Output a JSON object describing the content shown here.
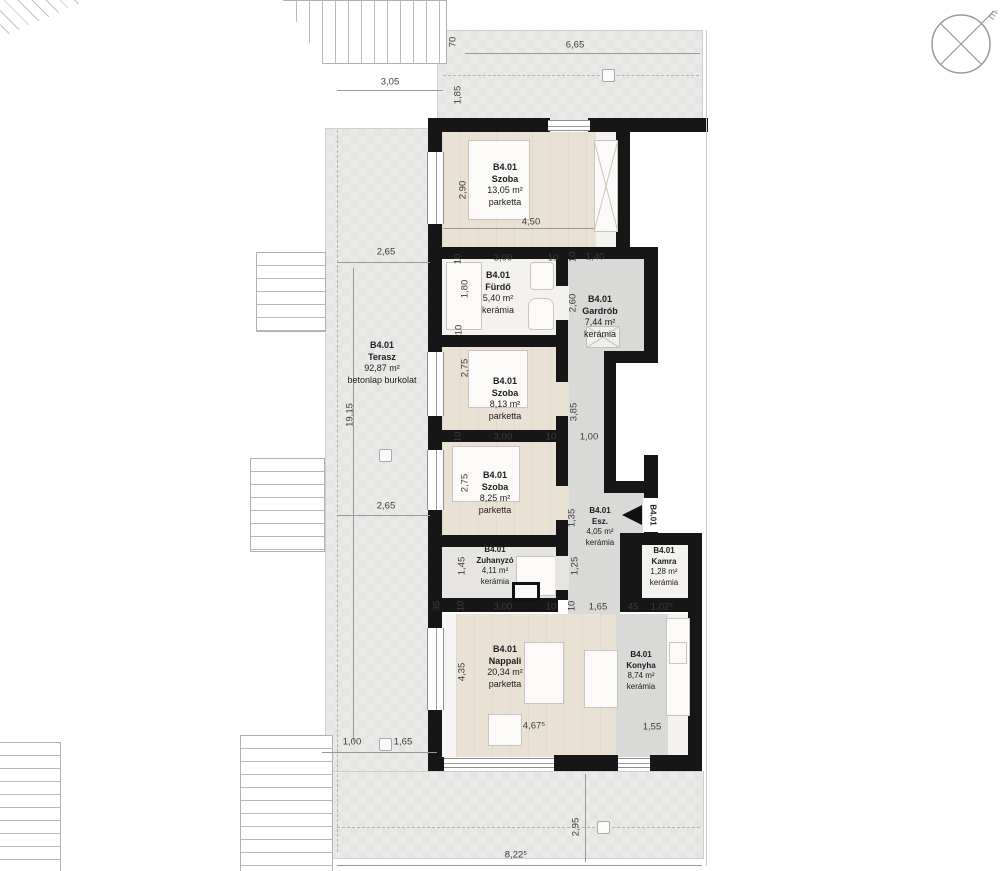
{
  "unit": "B4.01",
  "compass": {
    "north_label": "É"
  },
  "entry": {
    "unit": "B4.01"
  },
  "rooms": [
    {
      "id": "szoba-1",
      "unit": "B4.01",
      "name": "Szoba",
      "area": "13,05 m²",
      "floor": "parketta"
    },
    {
      "id": "furdo",
      "unit": "B4.01",
      "name": "Fürdő",
      "area": "5,40 m²",
      "floor": "kerámia"
    },
    {
      "id": "gardrob",
      "unit": "B4.01",
      "name": "Gardrób",
      "area": "7,44 m²",
      "floor": "kerámia"
    },
    {
      "id": "terasz",
      "unit": "B4.01",
      "name": "Terasz",
      "area": "92,87 m²",
      "floor": "betonlap burkolat"
    },
    {
      "id": "szoba-2",
      "unit": "B4.01",
      "name": "Szoba",
      "area": "8,13 m²",
      "floor": "parketta"
    },
    {
      "id": "szoba-3",
      "unit": "B4.01",
      "name": "Szoba",
      "area": "8,25 m²",
      "floor": "parketta"
    },
    {
      "id": "esz",
      "unit": "B4.01",
      "name": "Esz.",
      "area": "4,05 m²",
      "floor": "kerámia"
    },
    {
      "id": "zuhanyzo",
      "unit": "B4.01",
      "name": "Zuhanyzó",
      "area": "4,11 m²",
      "floor": "kerámia"
    },
    {
      "id": "kamra",
      "unit": "B4.01",
      "name": "Kamra",
      "area": "1,28 m²",
      "floor": "kerámia"
    },
    {
      "id": "nappali",
      "unit": "B4.01",
      "name": "Nappali",
      "area": "20,34 m²",
      "floor": "parketta"
    },
    {
      "id": "konyha",
      "unit": "B4.01",
      "name": "Konyha",
      "area": "8,74 m²",
      "floor": "kerámia"
    }
  ],
  "dimensions": [
    {
      "t": "70",
      "x": 453,
      "y": 42,
      "r": -90
    },
    {
      "t": "6,65",
      "x": 575,
      "y": 45,
      "r": 0
    },
    {
      "t": "3,05",
      "x": 390,
      "y": 82,
      "r": 0
    },
    {
      "t": "1,85",
      "x": 458,
      "y": 95,
      "r": -90
    },
    {
      "t": "2,65",
      "x": 386,
      "y": 252,
      "r": 0
    },
    {
      "t": "19,15",
      "x": 350,
      "y": 415,
      "r": -90
    },
    {
      "t": "2,65",
      "x": 386,
      "y": 506,
      "r": 0
    },
    {
      "t": "1,00",
      "x": 352,
      "y": 742,
      "r": 0
    },
    {
      "t": "1,65",
      "x": 403,
      "y": 742,
      "r": 0
    },
    {
      "t": "8,22⁵",
      "x": 516,
      "y": 855,
      "r": 0
    },
    {
      "t": "2,95",
      "x": 576,
      "y": 827,
      "r": -90
    },
    {
      "t": "2,90",
      "x": 463,
      "y": 190,
      "r": -90
    },
    {
      "t": "4,50",
      "x": 531,
      "y": 222,
      "r": 0
    },
    {
      "t": "10",
      "x": 458,
      "y": 259,
      "r": -90
    },
    {
      "t": "3,00",
      "x": 503,
      "y": 258,
      "r": 0
    },
    {
      "t": "10",
      "x": 553,
      "y": 258,
      "r": 0
    },
    {
      "t": "10",
      "x": 573,
      "y": 257,
      "r": -90
    },
    {
      "t": "1,40",
      "x": 595,
      "y": 257,
      "r": 0
    },
    {
      "t": "1,80",
      "x": 465,
      "y": 289,
      "r": -90
    },
    {
      "t": "2,60",
      "x": 573,
      "y": 303,
      "r": -90
    },
    {
      "t": "10",
      "x": 459,
      "y": 330,
      "r": -90
    },
    {
      "t": "2,75",
      "x": 465,
      "y": 368,
      "r": -90
    },
    {
      "t": "3,85",
      "x": 574,
      "y": 412,
      "r": -90
    },
    {
      "t": "10",
      "x": 458,
      "y": 437,
      "r": -90
    },
    {
      "t": "3,00",
      "x": 503,
      "y": 437,
      "r": 0
    },
    {
      "t": "10",
      "x": 551,
      "y": 437,
      "r": 0
    },
    {
      "t": "1,00",
      "x": 589,
      "y": 437,
      "r": 0
    },
    {
      "t": "2,75",
      "x": 465,
      "y": 483,
      "r": -90
    },
    {
      "t": "1,35",
      "x": 572,
      "y": 518,
      "r": -90
    },
    {
      "t": "1,45",
      "x": 462,
      "y": 566,
      "r": -90
    },
    {
      "t": "1,25",
      "x": 575,
      "y": 566,
      "r": -90
    },
    {
      "t": "35",
      "x": 437,
      "y": 606,
      "r": -90
    },
    {
      "t": "10",
      "x": 461,
      "y": 606,
      "r": -90
    },
    {
      "t": "3,00",
      "x": 503,
      "y": 607,
      "r": 0
    },
    {
      "t": "10",
      "x": 551,
      "y": 607,
      "r": 0
    },
    {
      "t": "10",
      "x": 572,
      "y": 606,
      "r": -90
    },
    {
      "t": "1,65",
      "x": 598,
      "y": 607,
      "r": 0
    },
    {
      "t": "45",
      "x": 633,
      "y": 607,
      "r": 0
    },
    {
      "t": "1,02⁵",
      "x": 662,
      "y": 607,
      "r": 0
    },
    {
      "t": "4,35",
      "x": 462,
      "y": 672,
      "r": -90
    },
    {
      "t": "4,67⁵",
      "x": 534,
      "y": 726,
      "r": 0
    },
    {
      "t": "1,55",
      "x": 652,
      "y": 727,
      "r": 0
    }
  ]
}
